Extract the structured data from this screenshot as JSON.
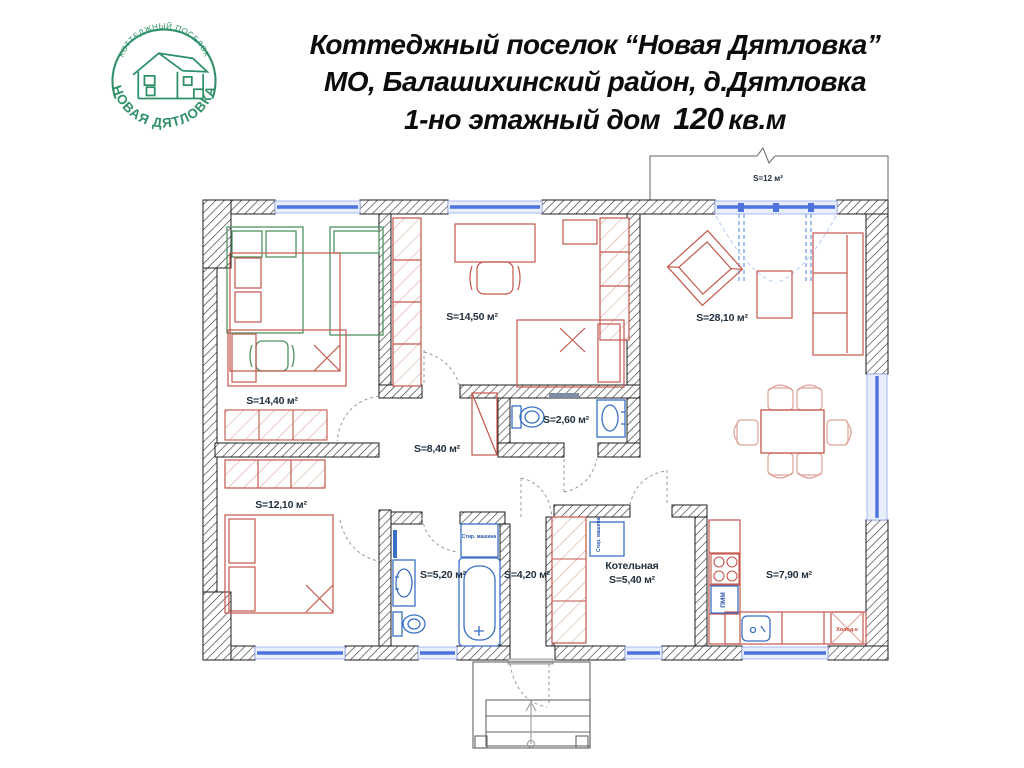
{
  "logo": {
    "arc_top": "КОТТЕДЖНЫЙ ПОСЕЛОК",
    "arc_bottom": "НОВАЯ ДЯТЛОВКА",
    "color": "#2f9068"
  },
  "header": {
    "line1": "Коттеджный поселок “Новая Дятловка”",
    "line2": "МО, Балашихинский район, д.Дятловка",
    "line3_prefix": "1-но этажный дом",
    "line3_area": "120",
    "line3_suffix": "кв.м"
  },
  "plan": {
    "terrace": {
      "label": "S=12 м²"
    },
    "rooms": [
      {
        "id": "bedroom-top-left",
        "label": "S=14,40 м²"
      },
      {
        "id": "bedroom-top-middle",
        "label": "S=14,50 м²"
      },
      {
        "id": "living-room",
        "label": "S=28,10 м²"
      },
      {
        "id": "wc",
        "label": "S=2,60 м²"
      },
      {
        "id": "hallway",
        "label": "S=8,40 м²"
      },
      {
        "id": "bedroom-bottom-left",
        "label": "S=12,10 м²"
      },
      {
        "id": "bathroom",
        "label": "S=5,20 м²"
      },
      {
        "id": "entrance-hall",
        "label": "S=4,20 м²"
      },
      {
        "id": "boiler-room",
        "name": "Котельная",
        "label": "S=5,40 м²"
      },
      {
        "id": "kitchen",
        "label": "S=7,90 м²"
      }
    ],
    "appliances": {
      "fridge": "Холод-к",
      "dishwasher": "ПММ",
      "washer_bathroom": "Стир. машина",
      "washer_boiler": "Стир. машина"
    },
    "colors": {
      "wall": "#1c1c1c",
      "window_blue": "#4e73dd",
      "furniture_red": "#c4564c",
      "furniture_salmon": "#dfa096",
      "furniture_green": "#4f9363",
      "fixture_blue": "#3a6fc4",
      "label_dark": "#22303d"
    }
  }
}
